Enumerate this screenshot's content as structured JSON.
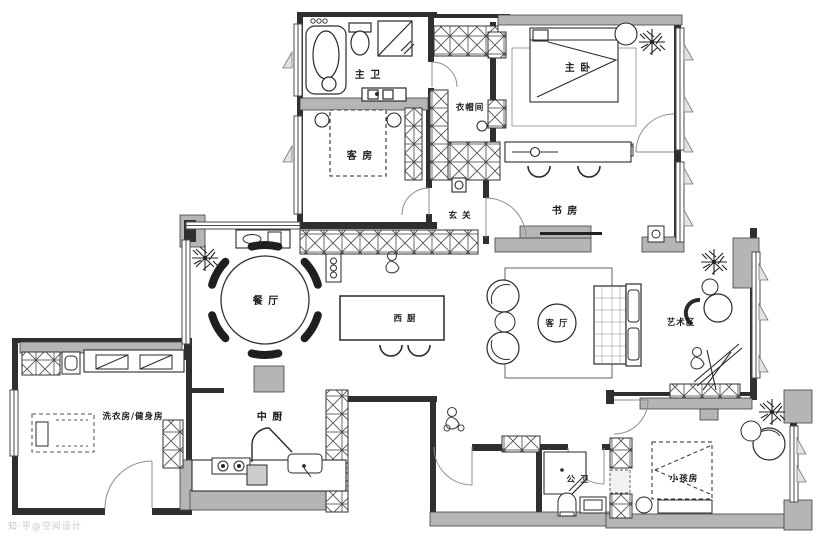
{
  "plan": {
    "watermark": "知·乎@空间设计",
    "rooms": [
      {
        "name": "master-bathroom",
        "label": "主 卫"
      },
      {
        "name": "master-bedroom",
        "label": "主 卧"
      },
      {
        "name": "cloakroom",
        "label": "衣帽间"
      },
      {
        "name": "guest-room",
        "label": "客 房"
      },
      {
        "name": "foyer",
        "label": "玄 关"
      },
      {
        "name": "study",
        "label": "书 房"
      },
      {
        "name": "dining-room",
        "label": "餐 厅"
      },
      {
        "name": "west-kitchen",
        "label": "西 厨"
      },
      {
        "name": "living-room",
        "label": "客 厅"
      },
      {
        "name": "art-zone",
        "label": "艺术区"
      },
      {
        "name": "laundry-gym",
        "label": "洗衣房/健身房"
      },
      {
        "name": "chinese-kitchen",
        "label": "中 厨"
      },
      {
        "name": "guest-bathroom",
        "label": "公 卫"
      },
      {
        "name": "kids-room",
        "label": "小孩房"
      }
    ]
  }
}
